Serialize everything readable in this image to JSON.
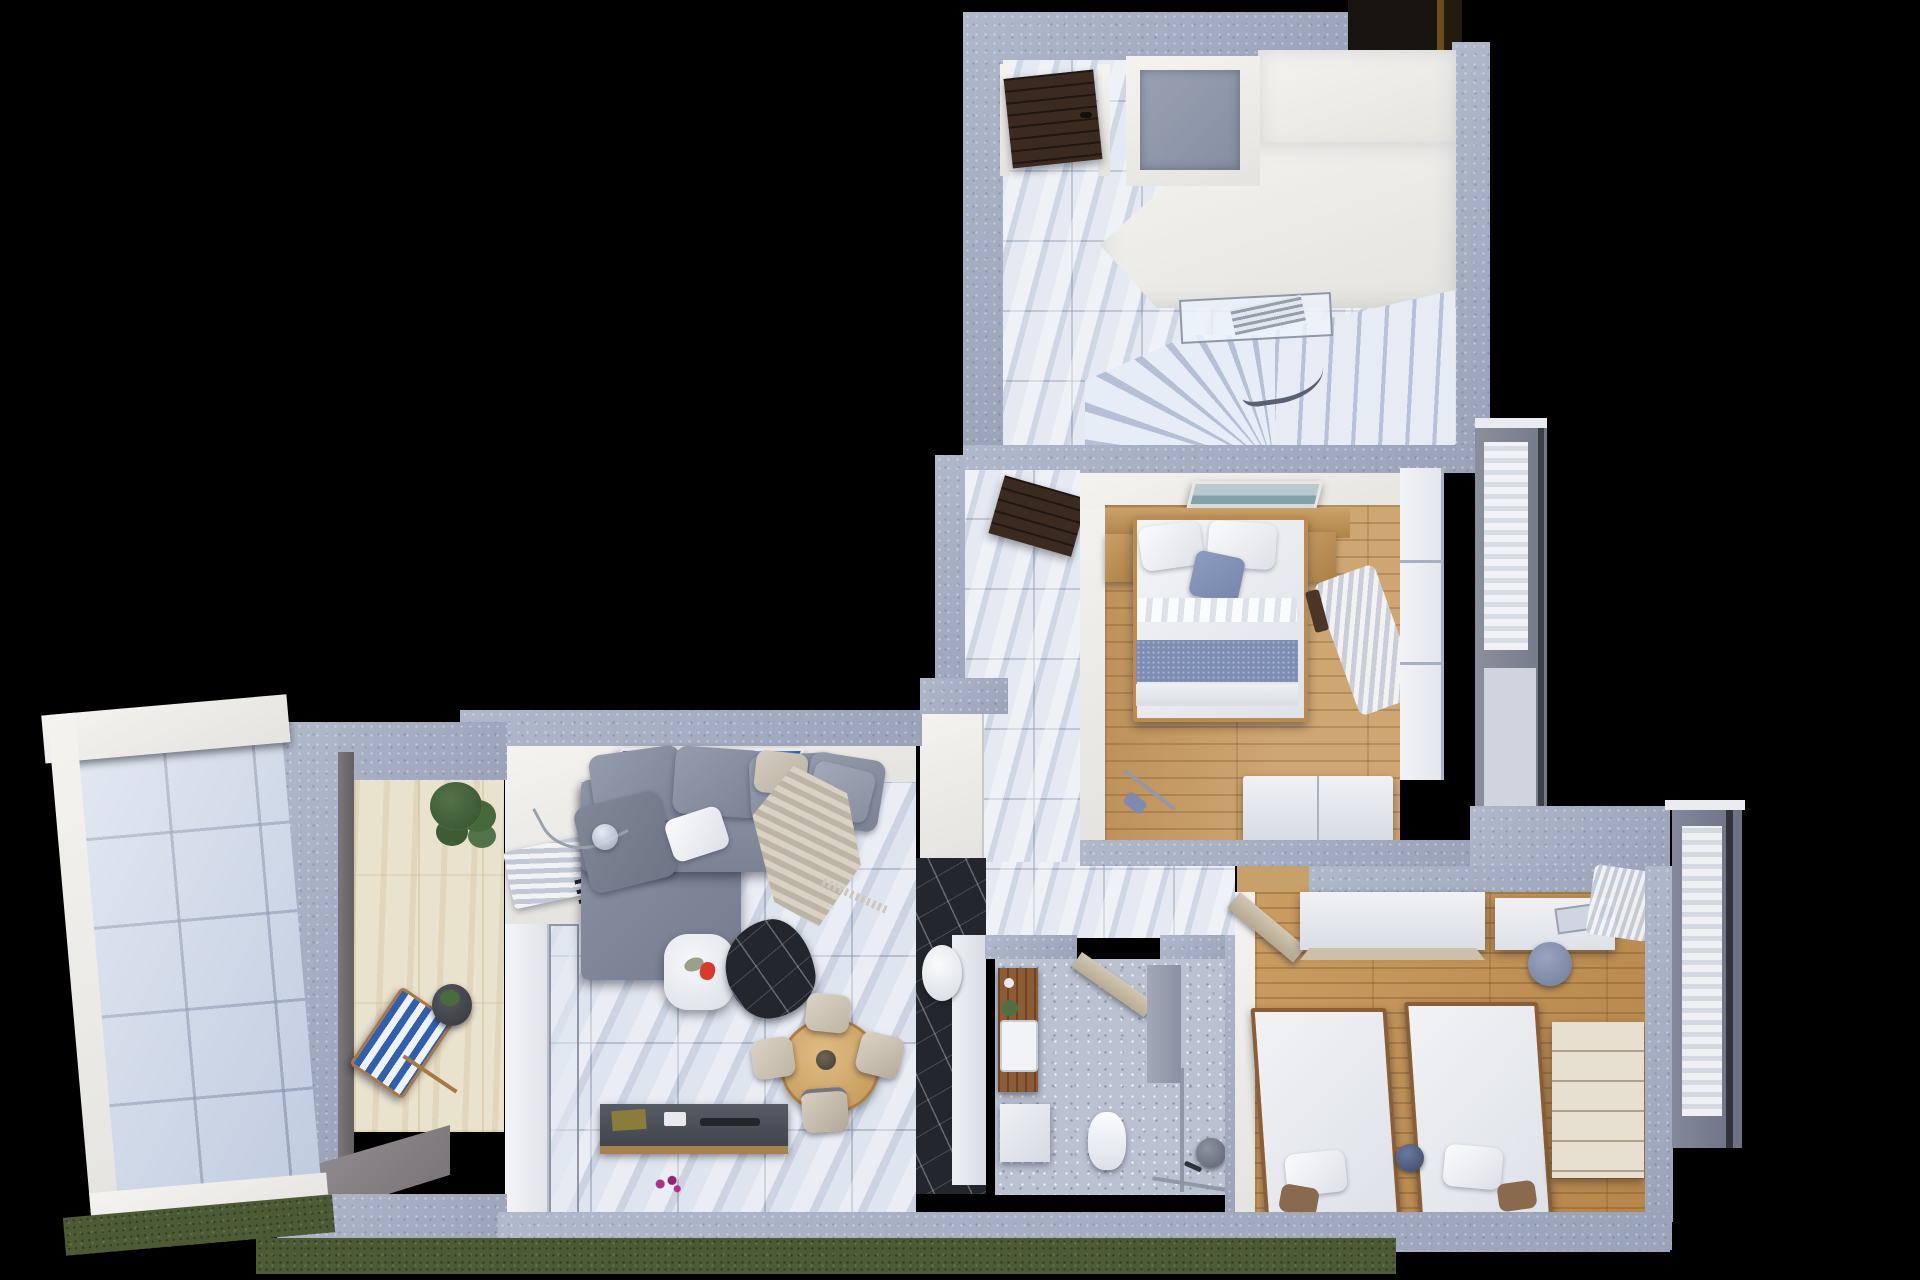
{
  "meta": {
    "description": "Top-down 3D architectural render of a furnished apartment floor plan on a black background",
    "view": "top-down axonometric",
    "visible_text": []
  },
  "palette": {
    "concrete": "#a7b0c5",
    "wall-white": "#f4f3f0",
    "marble": "#d8dfeb",
    "hall-marble": "#dde4ef",
    "wood-master": "#c89d66",
    "wood-kids": "#c09052",
    "terrazzo": "#bac1d0",
    "travertine": "#e9e2cd",
    "terrace-tile": "#cad5e7",
    "grass": "#4d5a36",
    "sofa": "#828a9b",
    "denim": "#7e8db4",
    "door-wood": "#3a2a1f",
    "door-beige": "#d2c7b2",
    "black-marble": "#23262c",
    "dresser": "#e7dfd0",
    "metal": "#8f96a3",
    "glass": "rgba(226,233,243,0.55)",
    "accent-red": "#d93b2b",
    "accent-magenta": "#b02f8a",
    "art-blue": "#3a77c8",
    "plant-green": "#47683a"
  },
  "scene": {
    "rooms": [
      {
        "name": "entry-hall-upper",
        "floor": "light marble tile",
        "features": [
          "dark-wood-entry-door",
          "utility-shaft",
          "white-storage-room",
          "winding-marble-staircase",
          "glass-railing-landing",
          "dark-roof-section"
        ]
      },
      {
        "name": "master-bedroom",
        "floor": "oak plank",
        "furniture": [
          "double-bed-white-bedding",
          "two-white-pillows",
          "blue-accent-cushion",
          "denim-throw-band",
          "wood-headboard-with-nightstands",
          "seascape-wall-art",
          "white-wardrobe",
          "floor-lamp",
          "sheer-curtains",
          "french-window"
        ]
      },
      {
        "name": "kids-bedroom",
        "floor": "oak plank",
        "furniture": [
          "single-bed-left",
          "single-bed-right",
          "white-wardrobe",
          "desk-with-chair",
          "cream-drawer-dresser",
          "toy-ball",
          "corner-curtains",
          "open-door"
        ]
      },
      {
        "name": "bathroom",
        "floor": "gray terrazzo",
        "fixtures": [
          "wood-vanity-with-white-sink",
          "base-cabinet",
          "toilet",
          "glass-shower-enclosure",
          "round-shower-stool",
          "open-beige-door",
          "black-marble-column",
          "white-basin-oval"
        ]
      },
      {
        "name": "living-dining-room",
        "floor": "white marble tile",
        "furniture": [
          "l-shaped-gray-sofa",
          "back-cushions",
          "white-pillow",
          "beige-pillow",
          "knit-throw",
          "blue-abstract-wall-art",
          "arc-floor-lamp-with-glass-globe",
          "white-coffee-table-with-red-flower",
          "black-marble-rug",
          "round-wood-dining-table",
          "four-beige-dining-chairs",
          "dark-tv-sideboard",
          "wall-radiator",
          "purple-floor-flower",
          "sliding-glass-doors"
        ]
      },
      {
        "name": "balcony",
        "floor": "travertine tile",
        "furniture": [
          "blue-striped-deck-chair",
          "round-side-table-with-plant",
          "green-shrub",
          "small-planter",
          "concrete-ramp"
        ]
      },
      {
        "name": "side-terrace",
        "floor": "large pale tiles",
        "features": [
          "white-parapet-walls",
          "white-roof-beam"
        ]
      }
    ],
    "exterior": [
      "black-backdrop",
      "grass-strip-along-south-wall",
      "speckled-concrete-wall-tops",
      "curtained-window-bands-east",
      "glazing-lines"
    ]
  }
}
